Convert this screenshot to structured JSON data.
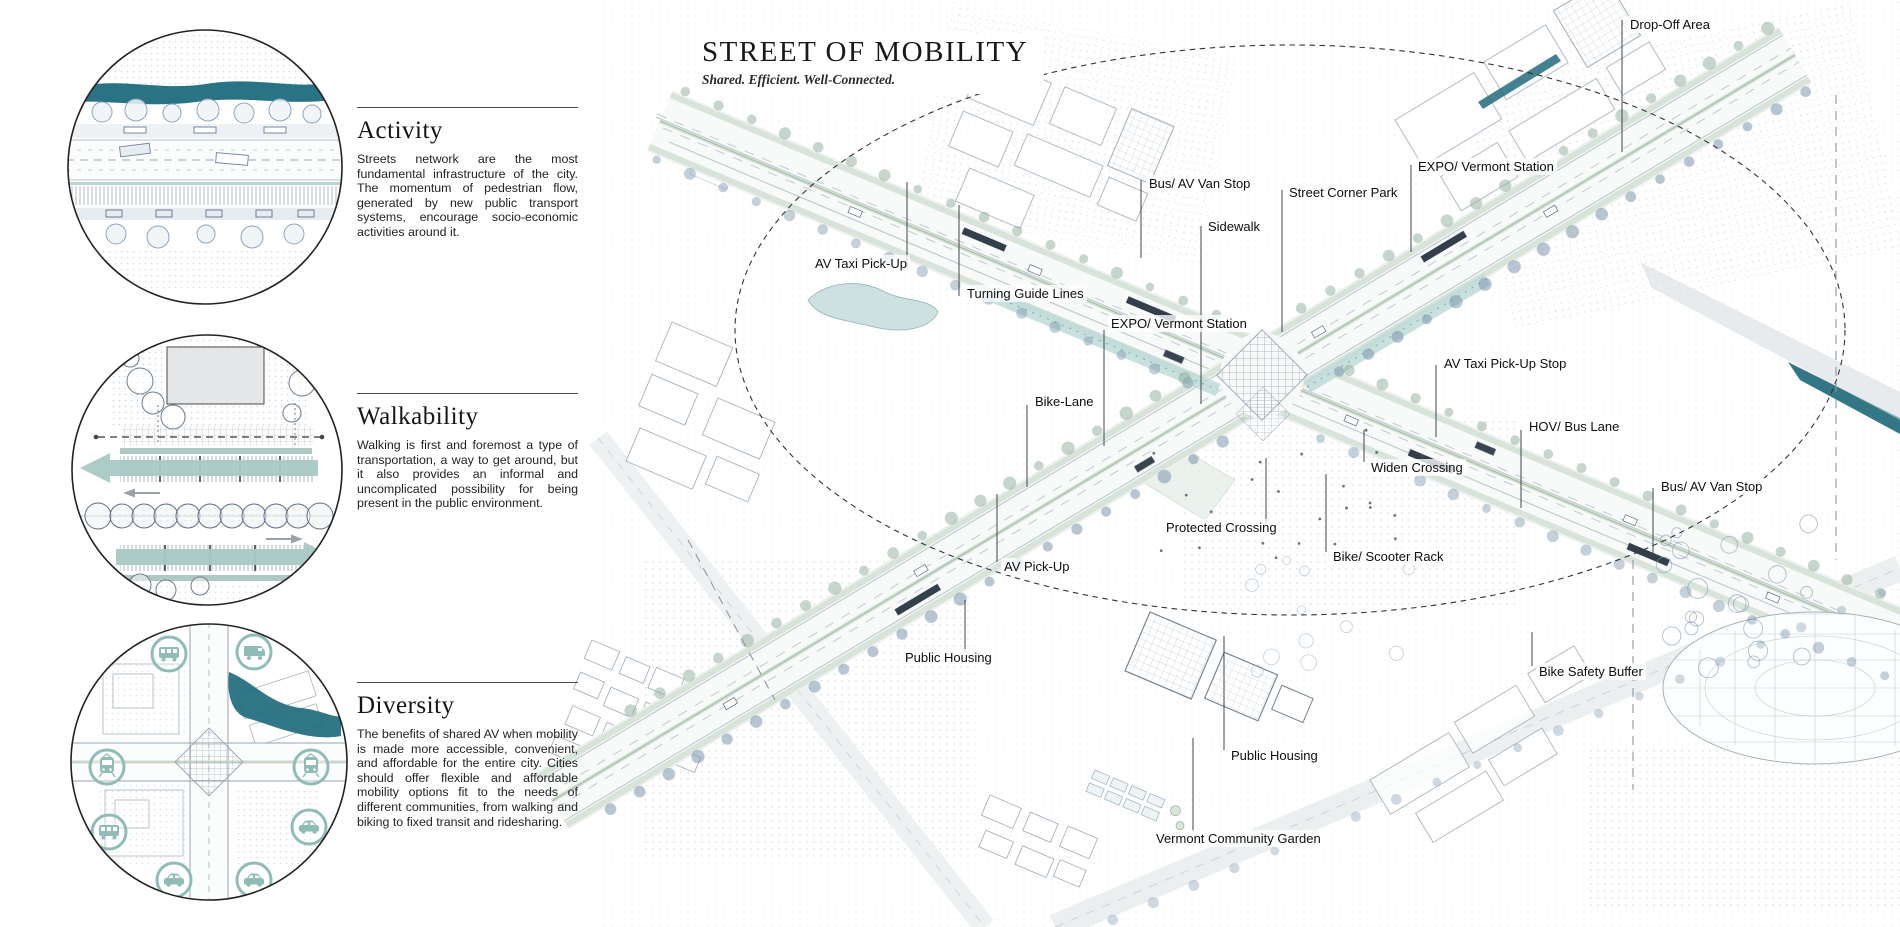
{
  "panel": {
    "sections": [
      {
        "title": "Activity",
        "body": "Streets network are the most fundamental infrastructure of the city. The momentum of pedestrian flow, generated by new public transport systems, encourage socio-economic activities around it."
      },
      {
        "title": "Walkability",
        "body": "Walking is first and foremost a type of transportation, a way to get around, but it also provides an informal and uncomplicated possibility for being present in the public environment."
      },
      {
        "title": "Diversity",
        "body": "The benefits of shared AV when mobility is made more accessible, convenient, and affordable for the entire city. Cities should offer flexible and affordable mobility options fit to the needs of different communities, from walking and biking to fixed transit and ridesharing."
      }
    ],
    "diversity_icons": [
      "bus",
      "van",
      "tram",
      "tram",
      "bus",
      "car",
      "car",
      "car"
    ]
  },
  "map": {
    "title": "STREET OF MOBILITY",
    "subtitle": "Shared. Efficient. Well-Connected.",
    "labels": [
      {
        "text": "Drop-Off Area"
      },
      {
        "text": "Bus/ AV Van Stop"
      },
      {
        "text": "Street Corner Park"
      },
      {
        "text": "EXPO/ Vermont Station"
      },
      {
        "text": "Sidewalk"
      },
      {
        "text": "AV Taxi Pick-Up"
      },
      {
        "text": "Turning Guide Lines"
      },
      {
        "text": "EXPO/ Vermont Station"
      },
      {
        "text": "Bike-Lane"
      },
      {
        "text": "AV Taxi Pick-Up Stop"
      },
      {
        "text": "HOV/ Bus Lane"
      },
      {
        "text": "Widen Crossing"
      },
      {
        "text": "Bus/ AV Van Stop"
      },
      {
        "text": "Protected Crossing"
      },
      {
        "text": "Bike/ Scooter Rack"
      },
      {
        "text": "AV Pick-Up"
      },
      {
        "text": "Public Housing"
      },
      {
        "text": "Bike Safety Buffer"
      },
      {
        "text": "Public Housing"
      },
      {
        "text": "Vermont Community Garden"
      }
    ]
  },
  "colors": {
    "teal_dark": "#1f6b7e",
    "teal_light": "#8fbcb7",
    "green_edge": "#d8e4da",
    "linework": "#9aa6b0",
    "ink": "#1c1c1c"
  }
}
